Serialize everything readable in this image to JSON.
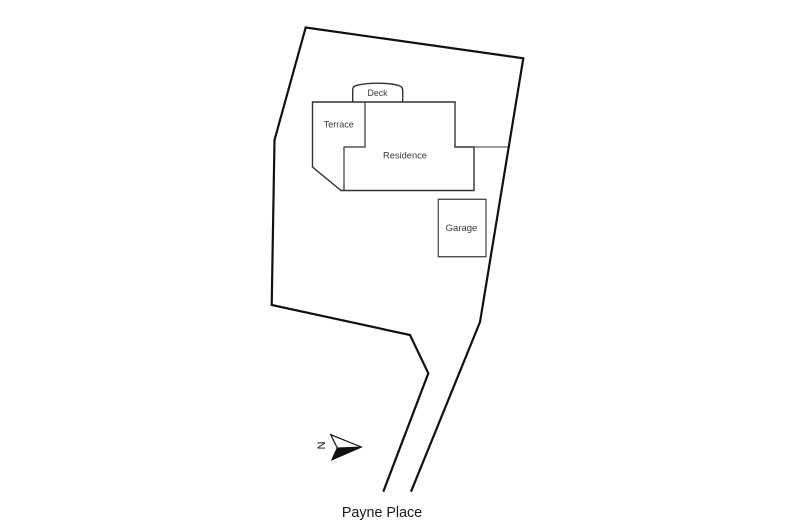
{
  "labels": {
    "deck": "Deck",
    "terrace": "Terrace",
    "residence": "Residence",
    "garage": "Garage",
    "north": "N",
    "street": "Payne Place"
  },
  "colors": {
    "background": "#ffffff",
    "boundary_line": "#111111",
    "building_line": "#333333",
    "garage_line": "#4f4f4f",
    "room_label_text": "#3a3a3a",
    "street_label_text": "#1a1a1a",
    "north_arrow_fill": "#111111"
  },
  "plan": {
    "boundary_points": "383.3,491.7 428.3,373.3 410,335 271.7,305 274.5,140 305.7,27.5 523.3,58.3 480,322 411,491.7",
    "building_outline_points": "312.5,102 455,102 455,147 474,147 474,190.5 341,190.5 312.5,167",
    "deck_path": "M 352.7,102 L 352.7,90 C 352.7,86.8 354.5,85.7 358.5,84.9 C 365,83.6 371,83.2 377.5,83.2 C 384,83.2 391,83.7 396.5,84.9 C 400.6,85.8 402.7,87 402.7,90.3 L 402.7,102",
    "terrace_divider_points": "365,102 365,147 344,147 344,190.5",
    "fence_points": "474,147 508,147",
    "garage_points": "438.3,199.3 486,199.3 486,256.7 438.3,256.7",
    "north_arrow": {
      "outline_points": "361.3,447 330.7,434.7 337.3,448 332,459.7",
      "solid_points": "361.3,447 337.3,448 332,459.7"
    }
  }
}
